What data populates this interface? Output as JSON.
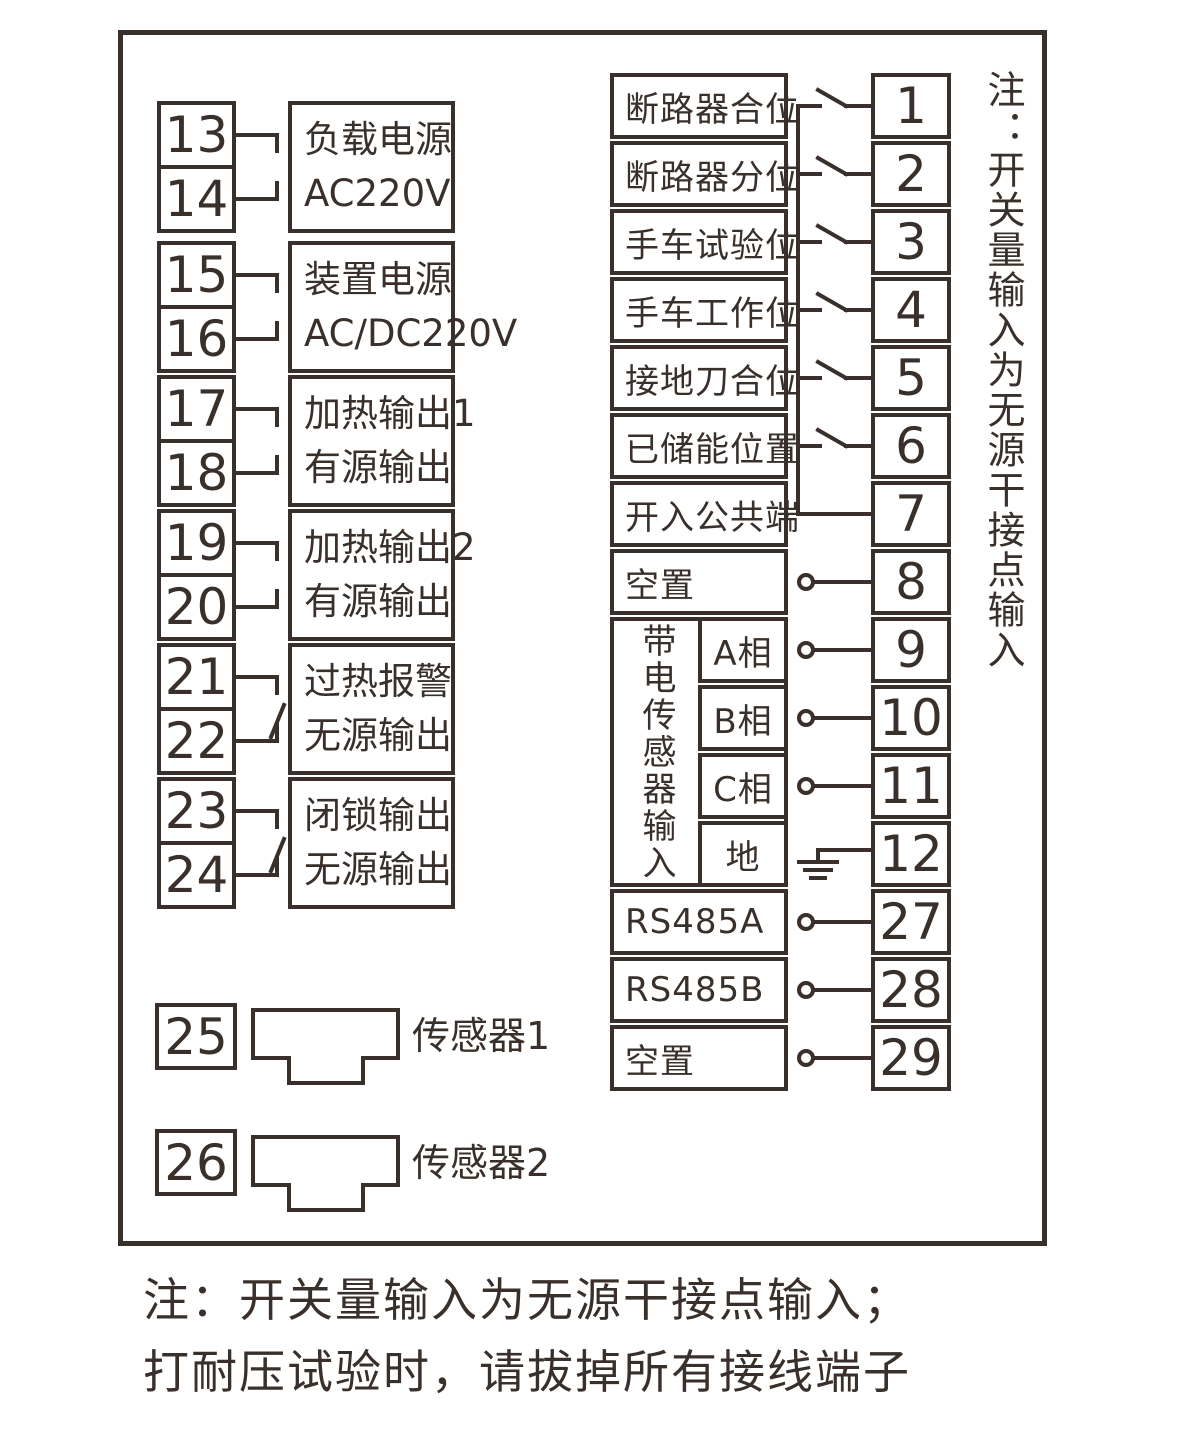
{
  "left": {
    "groups": [
      {
        "t1": "13",
        "t2": "14",
        "line1": "负载电源",
        "line2": "AC220V"
      },
      {
        "t1": "15",
        "t2": "16",
        "line1": "装置电源",
        "line2": "AC/DC220V"
      },
      {
        "t1": "17",
        "t2": "18",
        "line1": "加热输出1",
        "line2": "有源输出"
      },
      {
        "t1": "19",
        "t2": "20",
        "line1": "加热输出2",
        "line2": "有源输出"
      },
      {
        "t1": "21",
        "t2": "22",
        "line1": "过热报警",
        "line2": "无源输出"
      },
      {
        "t1": "23",
        "t2": "24",
        "line1": "闭锁输出",
        "line2": "无源输出"
      }
    ],
    "sensors": [
      {
        "terminal": "25",
        "label": "传感器1"
      },
      {
        "terminal": "26",
        "label": "传感器2"
      }
    ]
  },
  "right": {
    "rows": [
      {
        "label": "断路器合位",
        "terminal": "1"
      },
      {
        "label": "断路器分位",
        "terminal": "2"
      },
      {
        "label": "手车试验位",
        "terminal": "3"
      },
      {
        "label": "手车工作位",
        "terminal": "4"
      },
      {
        "label": "接地刀合位",
        "terminal": "5"
      },
      {
        "label": "已储能位置",
        "terminal": "6"
      },
      {
        "label": "开入公共端",
        "terminal": "7"
      },
      {
        "label": "空置",
        "terminal": "8"
      },
      {
        "label": "A相",
        "terminal": "9"
      },
      {
        "label": "B相",
        "terminal": "10"
      },
      {
        "label": "C相",
        "terminal": "11"
      },
      {
        "label": "地",
        "terminal": "12"
      },
      {
        "label": "RS485A",
        "terminal": "27"
      },
      {
        "label": "RS485B",
        "terminal": "28"
      },
      {
        "label": "空置",
        "terminal": "29"
      }
    ],
    "sensor_group_label": "带电传感器输入"
  },
  "side_note": "注：开关量输入为无源干接点输入",
  "footer_line1": "注：开关量输入为无源干接点输入；",
  "footer_line2": "打耐压试验时，请拔掉所有接线端子",
  "colors": {
    "ink": "#39302b",
    "background": "#ffffff"
  }
}
